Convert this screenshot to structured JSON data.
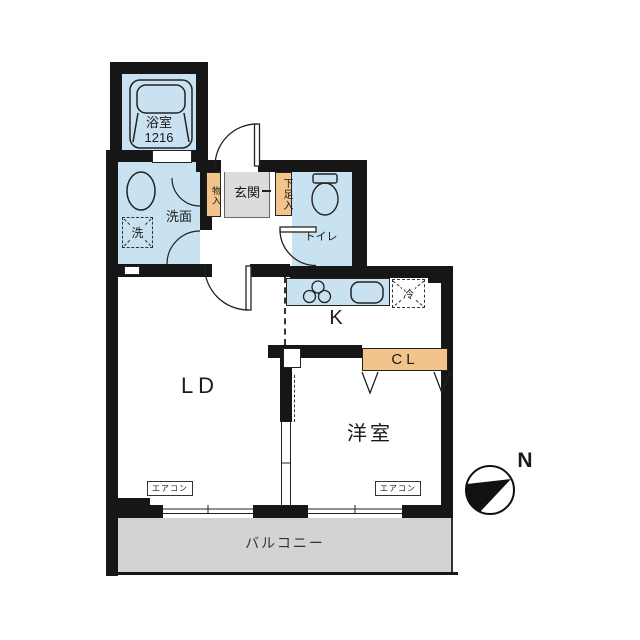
{
  "plan": {
    "bathroom": {
      "label": "浴室",
      "size": "1216"
    },
    "washroom": {
      "label": "洗面"
    },
    "washer": {
      "label": "洗"
    },
    "storage": {
      "label": "物入"
    },
    "entrance": {
      "label": "玄関"
    },
    "shoe_storage": {
      "label": "下足入"
    },
    "toilet": {
      "label": "トイレ"
    },
    "kitchen": {
      "label": "K"
    },
    "fridge": {
      "label": "冷"
    },
    "closet": {
      "label": "CL"
    },
    "living_dining": {
      "label": "LD"
    },
    "western_room": {
      "label": "洋室"
    },
    "aircon_ld": {
      "label": "エアコン"
    },
    "aircon_western": {
      "label": "エアコン"
    },
    "balcony": {
      "label": "バルコニー"
    },
    "compass": {
      "label": "N"
    }
  },
  "colors": {
    "wall": "#161616",
    "room_blue": "#c9e2f1",
    "accent_orange": "#f3c38c",
    "entrance_gray": "#dcdcdc",
    "balcony_gray": "#d3d3d3"
  }
}
